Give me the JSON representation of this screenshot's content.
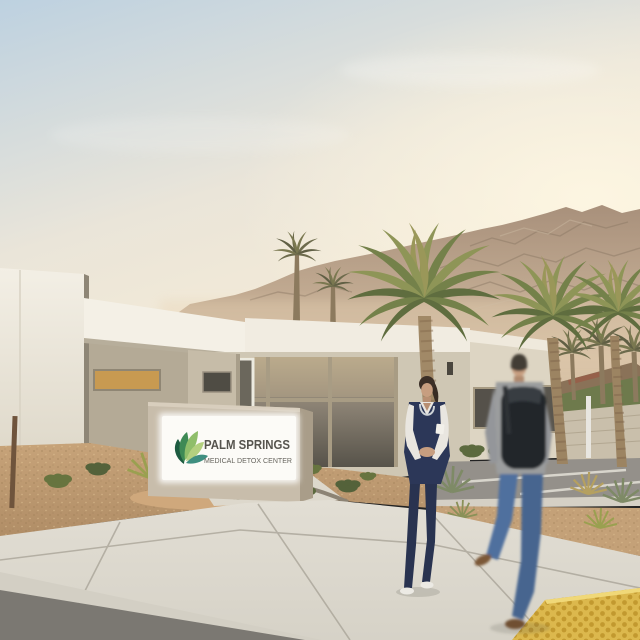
{
  "scene": {
    "type": "photograph",
    "subject": "single-story medical facility exterior at dusk with palm trees and mountains",
    "sign": {
      "title": "PALM SPRINGS",
      "subtitle": "MEDICAL DETOX CENTER"
    },
    "people": {
      "left": "nurse-in-navy-scrubs",
      "right": "man-with-backpack-walking"
    }
  },
  "palette": {
    "sky_top": "#bdd1e0",
    "sky_mid": "#eae5d9",
    "sky_warm": "#f7ecd6",
    "sun_glow": "#fdf6e2",
    "mountain": "#a8907b",
    "mountain_haze": "#d8c2a6",
    "building_white": "#f3efe5",
    "building_cream": "#ddd5c3",
    "building_tan": "#bfb5a0",
    "window_glass": "#57534a",
    "window_frame": "#a89c84",
    "amber_window": "#c89a51",
    "sign_body": "#c8bdab",
    "sign_panel": "#fcfbf7",
    "sign_text": "#56544e",
    "sign_subtext": "#66645d",
    "leaf_dark": "#1d5b40",
    "leaf_mid": "#3e8a55",
    "leaf_light": "#8fbe6a",
    "leaf_pale": "#b3d07f",
    "leaf_teal": "#3f8f80",
    "palm_green": "#74814a",
    "palm_gold": "#9a9759",
    "palm_dark": "#5f6d3f",
    "trunk": "#a18967",
    "gravel": "#c7a379",
    "gravel_dark": "#b08d66",
    "sidewalk": "#d6d2c7",
    "sidewalk_far": "#e2ded4",
    "street": "#7b7872",
    "curb": "#d3cfc4",
    "tactile_yellow": "#dcb84d",
    "tactile_dot": "#c2992f",
    "scrubs_navy": "#2c3758",
    "shirt_white": "#e9e6e0",
    "sweater_gray": "#9b9d9e",
    "backpack_black": "#23262b",
    "jeans_blue": "#4f6f9e",
    "skin": "#c79e80"
  }
}
